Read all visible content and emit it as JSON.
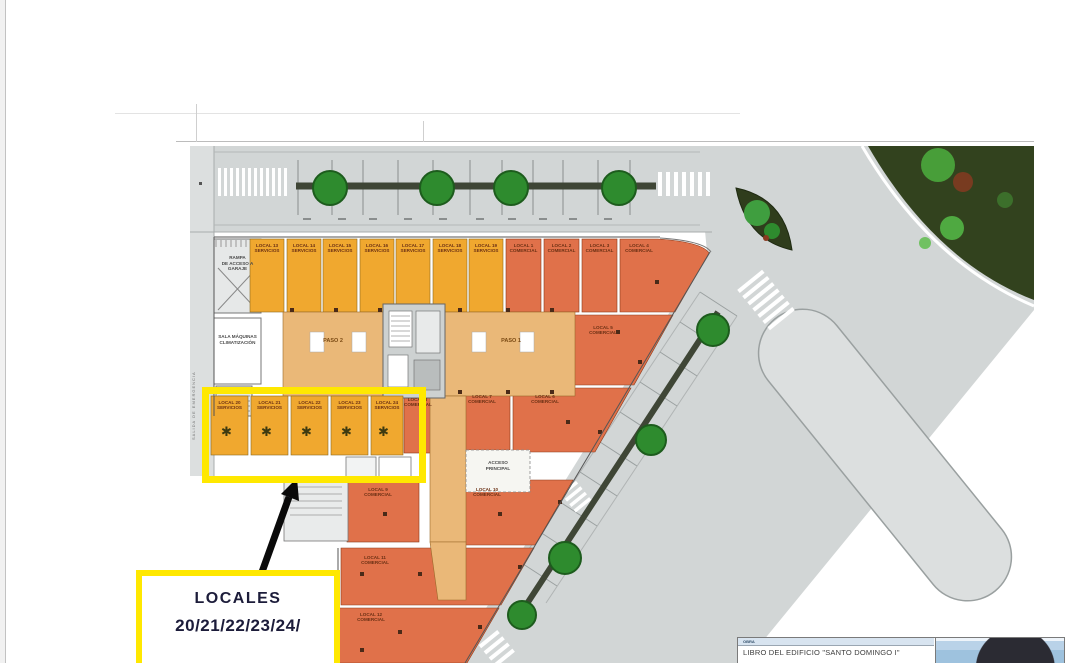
{
  "plan": {
    "locales_top": [
      {
        "name": "LOCAL 13",
        "type": "SERVICIOS"
      },
      {
        "name": "LOCAL 14",
        "type": "SERVICIOS"
      },
      {
        "name": "LOCAL 15",
        "type": "SERVICIOS"
      },
      {
        "name": "LOCAL 16",
        "type": "SERVICIOS"
      },
      {
        "name": "LOCAL 17",
        "type": "SERVICIOS"
      },
      {
        "name": "LOCAL 18",
        "type": "SERVICIOS"
      },
      {
        "name": "LOCAL 19",
        "type": "SERVICIOS"
      }
    ],
    "locales_right": [
      {
        "name": "LOCAL 1",
        "type": "COMERCIAL"
      },
      {
        "name": "LOCAL 2",
        "type": "COMERCIAL"
      },
      {
        "name": "LOCAL 3",
        "type": "COMERCIAL"
      },
      {
        "name": "LOCAL 4",
        "type": "COMERCIAL"
      }
    ],
    "locales_mid": [
      {
        "name": "LOCAL 5",
        "type": "COMERCIAL"
      },
      {
        "name": "LOCAL 6",
        "type": "COMERCIAL"
      },
      {
        "name": "LOCAL 7",
        "type": "COMERCIAL"
      },
      {
        "name": "LOCAL 8",
        "type": "COMERCIAL"
      },
      {
        "name": "LOCAL 9",
        "type": "COMERCIAL"
      },
      {
        "name": "LOCAL 10",
        "type": "COMERCIAL"
      },
      {
        "name": "LOCAL 11",
        "type": "COMERCIAL"
      },
      {
        "name": "LOCAL 12",
        "type": "COMERCIAL"
      }
    ],
    "locales_bottom": [
      {
        "name": "LOCAL 20",
        "type": "SERVICIOS"
      },
      {
        "name": "LOCAL 21",
        "type": "SERVICIOS"
      },
      {
        "name": "LOCAL 22",
        "type": "SERVICIOS"
      },
      {
        "name": "LOCAL 23",
        "type": "SERVICIOS"
      },
      {
        "name": "LOCAL 24",
        "type": "SERVICIOS"
      }
    ],
    "rooms": {
      "rampa": [
        "RAMPA",
        "DE ACCESO A",
        "GARAJE"
      ],
      "sala": [
        "SALA MÁQUINAS",
        "CLIMATIZACIÓN"
      ],
      "paso1": "PASO 1",
      "paso2": "PASO 2",
      "acceso": [
        "ACCESO",
        "PRINCIPAL"
      ],
      "salida": "SALIDA DE EMERGENCIA"
    }
  },
  "annotation": {
    "label_line1": "LOCALES",
    "label_line2": "20/21/22/23/24/"
  },
  "title_block": {
    "header": "OBRA",
    "title": "LIBRO DEL EDIFICIO  \"SANTO DOMINGO I\""
  },
  "icons": {
    "palm_tree": "✱"
  },
  "colors": {
    "highlight_yellow": "#FFE800",
    "comercial_orange": "#E0714A",
    "servicios_yellow": "#F0A82F",
    "paso_tan": "#EAB878",
    "road_gray": "#D2D6D6",
    "tree_green": "#2E8B2E",
    "landscape_green": "#32421E",
    "label_navy": "#1C1C3A",
    "title_header_blue": "#D8E4F0"
  }
}
